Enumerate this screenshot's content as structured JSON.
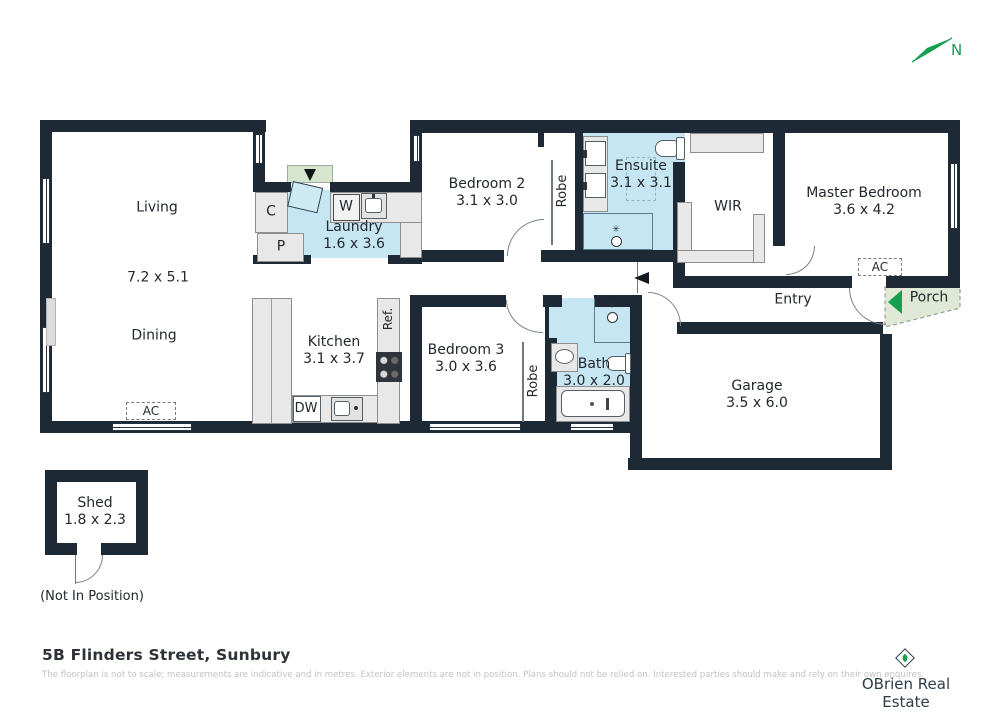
{
  "compass": {
    "north": "N"
  },
  "rooms": {
    "living": {
      "name": "Living",
      "dims": "7.2 x 5.1"
    },
    "dining": {
      "name": "Dining"
    },
    "laundry": {
      "name": "Laundry",
      "dims": "1.6 x 3.6"
    },
    "kitchen": {
      "name": "Kitchen",
      "dims": "3.1 x 3.7"
    },
    "bedroom2": {
      "name": "Bedroom 2",
      "dims": "3.1 x 3.0"
    },
    "bedroom3": {
      "name": "Bedroom 3",
      "dims": "3.0 x 3.6"
    },
    "ensuite": {
      "name": "Ensuite",
      "dims": "3.1 x 3.1"
    },
    "wir": {
      "name": "WIR"
    },
    "master": {
      "name": "Master Bedroom",
      "dims": "3.6 x 4.2"
    },
    "entry": {
      "name": "Entry"
    },
    "porch": {
      "name": "Porch"
    },
    "bath": {
      "name": "Bath",
      "dims": "3.0 x 2.0"
    },
    "garage": {
      "name": "Garage",
      "dims": "3.5 x 6.0"
    },
    "shed": {
      "name": "Shed",
      "dims": "1.8 x 2.3",
      "note": "(Not In Position)"
    }
  },
  "fixtures": {
    "cupboard": "C",
    "pantry": "P",
    "washer": "W",
    "dishwasher": "DW",
    "fridge": "Ref.",
    "robe": "Robe",
    "ac": "AC"
  },
  "footer": {
    "address": "5B Flinders Street, Sunbury",
    "disclaimer": "The floorplan is not to scale; measurements are indicative and in metres. Exterior elements are not in position. Plans should not be relied on. Interested parties should make and rely on their own enquires.",
    "brand": "OBrien Real Estate"
  },
  "colors": {
    "wall": "#1d2935",
    "wet_area": "#c5e6f2",
    "fixture": "#e8e8e8",
    "porch": "#dfe9d6",
    "accent_green": "#13a04f",
    "muted_text": "#c2c2c2"
  }
}
